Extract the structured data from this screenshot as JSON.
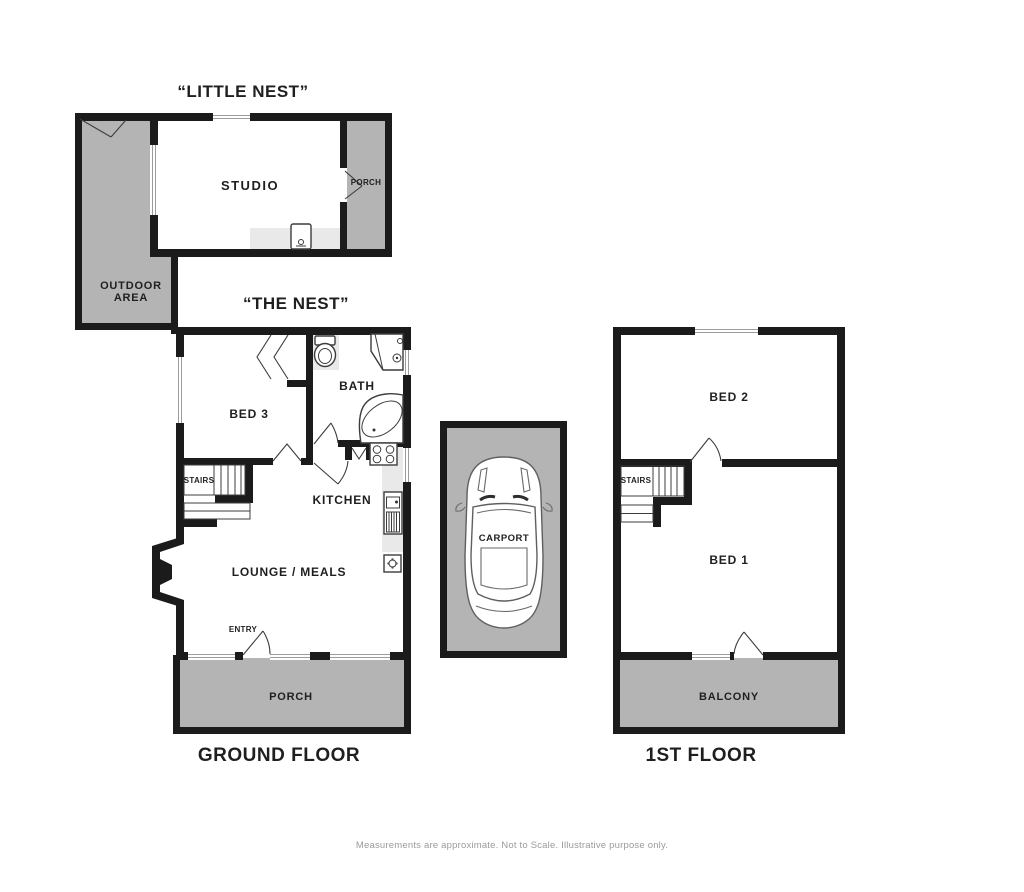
{
  "titles": {
    "little_nest": "“LITTLE NEST”",
    "the_nest": "“THE NEST”"
  },
  "floor_labels": {
    "ground": "GROUND FLOOR",
    "first": "1ST FLOOR"
  },
  "little_nest": {
    "studio": "STUDIO",
    "porch": "PORCH",
    "outdoor_area_line1": "OUTDOOR",
    "outdoor_area_line2": "AREA"
  },
  "ground_floor": {
    "bed3": "BED 3",
    "bath": "BATH",
    "stairs": "STAIRS",
    "kitchen": "KITCHEN",
    "lounge": "LOUNGE / MEALS",
    "entry": "ENTRY",
    "porch": "PORCH"
  },
  "first_floor": {
    "bed2": "BED 2",
    "bed1": "BED 1",
    "stairs": "STAIRS",
    "balcony": "BALCONY"
  },
  "carport": {
    "label": "CARPORT"
  },
  "footer": {
    "note": "Measurements are approximate.  Not to Scale.  Illustrative purpose only."
  },
  "colors": {
    "wall": "#1b1b1b",
    "area_gray": "#b4b4b4",
    "counter_gray": "#e9e9e9",
    "line": "#3c3c3c",
    "text": "#1f1f1f",
    "footer_text": "#9b9b9b",
    "background": "#ffffff"
  }
}
